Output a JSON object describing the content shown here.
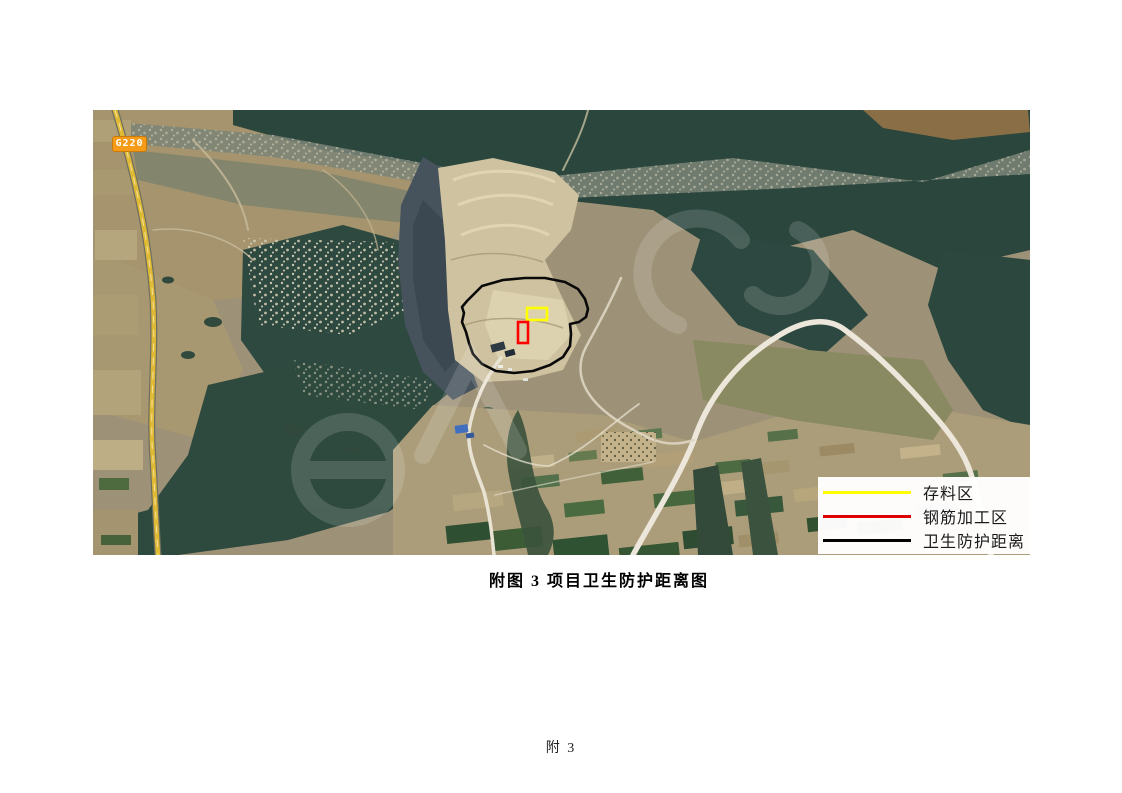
{
  "page": {
    "caption": "附图 3  项目卫生防护距离图",
    "page_number": "附 3"
  },
  "map": {
    "road_badge": "G220",
    "legend": {
      "items": [
        {
          "label": "存料区",
          "color": "#ffff00"
        },
        {
          "label": "钢筋加工区",
          "color": "#dd0000"
        },
        {
          "label": "卫生防护距离",
          "color": "#000000"
        }
      ]
    },
    "overlays": {
      "storage_area_color": "#ffff00",
      "rebar_area_color": "#ff0000",
      "protection_boundary_color": "#000000"
    }
  }
}
